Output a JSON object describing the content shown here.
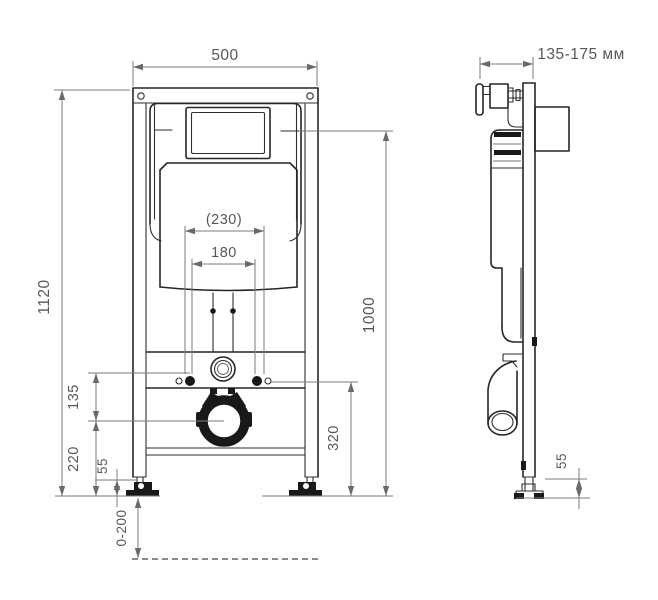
{
  "drawing": {
    "title_hint": "wall-hung toilet installation frame, two orthographic views",
    "front_view": {
      "frame_width": "500",
      "frame_height": "1120",
      "mount_spacing_outer": "(230)",
      "mount_spacing_inner": "180",
      "bolt_to_drain": "135",
      "drain_to_floor": "220",
      "foot_height": "55",
      "height_adjust_range": "0-200",
      "drain_center_height": "320",
      "actuator_height": "1000"
    },
    "side_view": {
      "installation_depth": "135-175 мм",
      "foot_height": "55"
    },
    "colors": {
      "background": "#ffffff",
      "drawing_line": "#262626",
      "dimension_line": "#7b7b7b",
      "dimension_text": "#575757"
    }
  }
}
